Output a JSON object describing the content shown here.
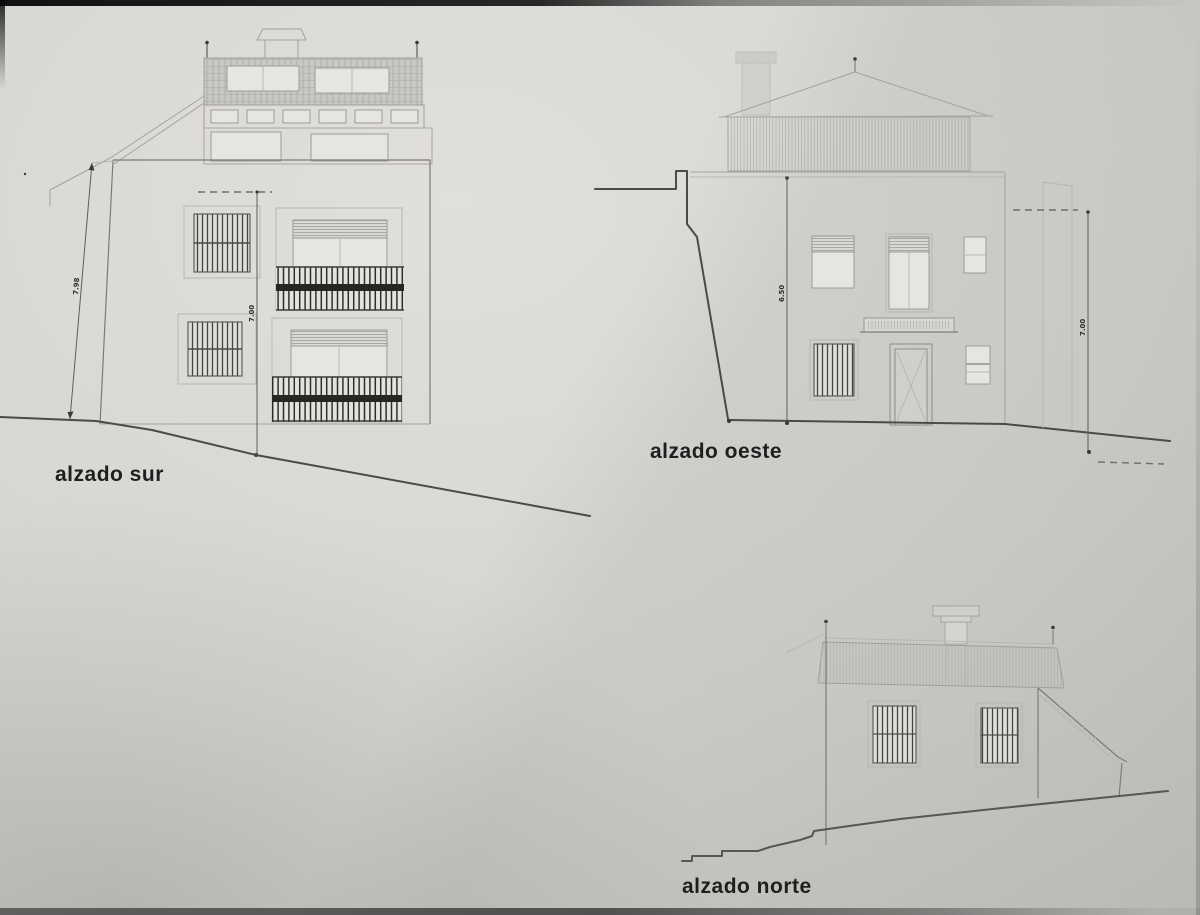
{
  "colors": {
    "paper": "#d6d5d2",
    "paper_light": "#e0dfdc",
    "paper_dark": "#b6b5b2",
    "ink_strong": "#1f1f1f",
    "ink_line": "#4a4a48",
    "ink_medium": "#7c7b78",
    "ink_faint": "#a3a29e"
  },
  "elevations": {
    "south": {
      "label": "alzado sur",
      "dim_left": "7.98",
      "dim_mid": "7.00"
    },
    "west": {
      "label": "alzado oeste",
      "dim_mid": "6.50",
      "dim_right": "7.00"
    },
    "north": {
      "label": "alzado norte"
    }
  }
}
